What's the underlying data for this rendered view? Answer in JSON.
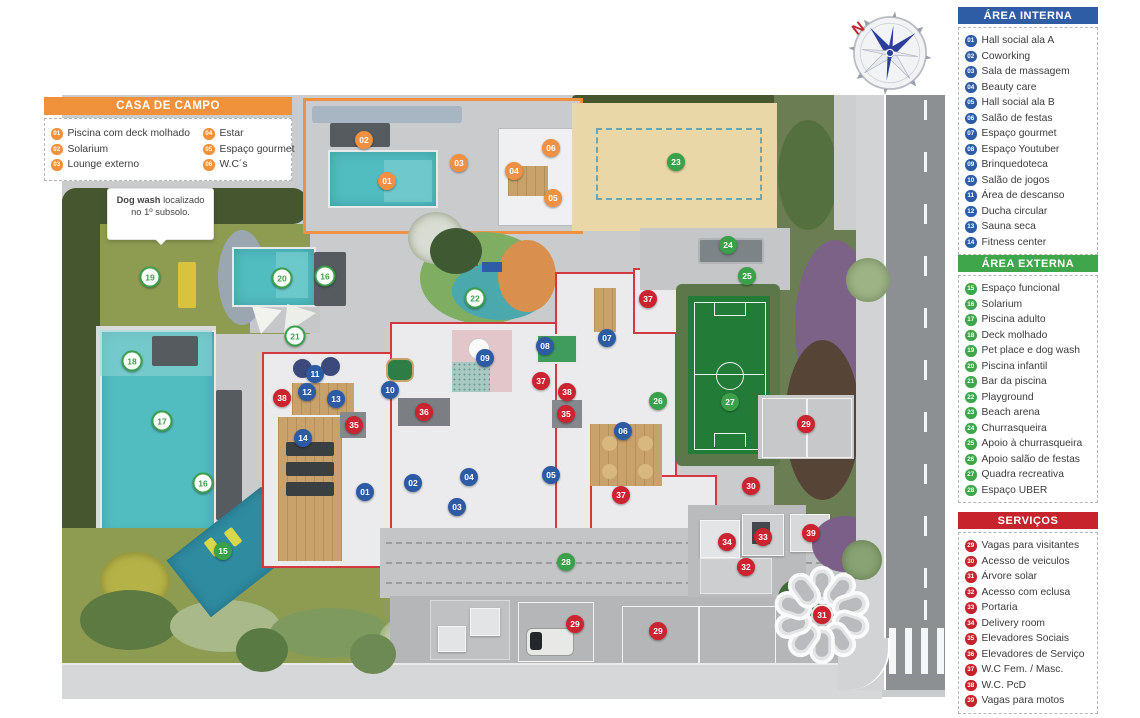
{
  "colors": {
    "area_interna": "#2e5da6",
    "area_externa": "#3fa64c",
    "servicos": "#c7232c",
    "casa_de_campo": "#f0913c",
    "pool_water": "#52bdc1",
    "court_green": "#237b38",
    "sand": "#e9d7a7",
    "building_outline_red": "#d23a40"
  },
  "compass": {
    "label": "N"
  },
  "note": {
    "bold": "Dog wash",
    "rest": " localizado no 1º subsolo."
  },
  "legends": {
    "casa_de_campo": {
      "title": "CASA DE CAMPO",
      "col1": [
        {
          "n": "01",
          "label": "Piscina com deck molhado"
        },
        {
          "n": "02",
          "label": "Solarium"
        },
        {
          "n": "03",
          "label": "Lounge externo"
        }
      ],
      "col2": [
        {
          "n": "04",
          "label": "Estar"
        },
        {
          "n": "05",
          "label": "Espaço gourmet"
        },
        {
          "n": "06",
          "label": "W.C´s"
        }
      ]
    },
    "area_interna": {
      "title": "ÁREA  INTERNA",
      "items": [
        {
          "n": "01",
          "label": "Hall social ala A"
        },
        {
          "n": "02",
          "label": "Coworking"
        },
        {
          "n": "03",
          "label": "Sala de massagem"
        },
        {
          "n": "04",
          "label": "Beauty care"
        },
        {
          "n": "05",
          "label": "Hall social ala B"
        },
        {
          "n": "06",
          "label": "Salão de festas"
        },
        {
          "n": "07",
          "label": "Espaço gourmet"
        },
        {
          "n": "08",
          "label": "Espaço Youtuber"
        },
        {
          "n": "09",
          "label": "Brinquedoteca"
        },
        {
          "n": "10",
          "label": "Salão de jogos"
        },
        {
          "n": "11",
          "label": "Área de descanso"
        },
        {
          "n": "12",
          "label": "Ducha circular"
        },
        {
          "n": "13",
          "label": "Sauna seca"
        },
        {
          "n": "14",
          "label": "Fitness center"
        }
      ]
    },
    "area_externa": {
      "title": "ÁREA EXTERNA",
      "items": [
        {
          "n": "15",
          "label": "Espaço funcional"
        },
        {
          "n": "16",
          "label": "Solarium"
        },
        {
          "n": "17",
          "label": "Piscina adulto"
        },
        {
          "n": "18",
          "label": "Deck molhado"
        },
        {
          "n": "19",
          "label": "Pet place e dog wash"
        },
        {
          "n": "20",
          "label": "Piscina infantil"
        },
        {
          "n": "21",
          "label": "Bar da piscina"
        },
        {
          "n": "22",
          "label": "Playground"
        },
        {
          "n": "23",
          "label": "Beach arena"
        },
        {
          "n": "24",
          "label": "Churrasqueira"
        },
        {
          "n": "25",
          "label": "Apoio à churrasqueira"
        },
        {
          "n": "26",
          "label": "Apoio salão de festas"
        },
        {
          "n": "27",
          "label": "Quadra recreativa"
        },
        {
          "n": "28",
          "label": "Espaço UBER"
        }
      ]
    },
    "servicos": {
      "title": "SERVIÇOS",
      "items": [
        {
          "n": "29",
          "label": "Vagas para visitantes"
        },
        {
          "n": "30",
          "label": "Acesso de veiculos"
        },
        {
          "n": "31",
          "label": "Árvore solar"
        },
        {
          "n": "32",
          "label": "Acesso com eclusa"
        },
        {
          "n": "33",
          "label": "Portaria"
        },
        {
          "n": "34",
          "label": "Delivery room"
        },
        {
          "n": "35",
          "label": "Elevadores Sociais"
        },
        {
          "n": "36",
          "label": "Elevadores de Serviço"
        },
        {
          "n": "37",
          "label": "W.C Fem. / Masc."
        },
        {
          "n": "38",
          "label": "W.C. PcD"
        },
        {
          "n": "39",
          "label": "Vagas para motos"
        }
      ]
    }
  },
  "plan": {
    "markers": [
      {
        "n": "01",
        "type": "orange",
        "x": 387,
        "y": 181
      },
      {
        "n": "02",
        "type": "orange",
        "x": 364,
        "y": 140
      },
      {
        "n": "03",
        "type": "orange",
        "x": 459,
        "y": 163
      },
      {
        "n": "04",
        "type": "orange",
        "x": 514,
        "y": 171
      },
      {
        "n": "05",
        "type": "orange",
        "x": 553,
        "y": 198
      },
      {
        "n": "06",
        "type": "orange",
        "x": 551,
        "y": 148
      },
      {
        "n": "01",
        "type": "blue",
        "x": 365,
        "y": 492
      },
      {
        "n": "02",
        "type": "blue",
        "x": 413,
        "y": 483
      },
      {
        "n": "03",
        "type": "blue",
        "x": 457,
        "y": 507
      },
      {
        "n": "04",
        "type": "blue",
        "x": 469,
        "y": 477
      },
      {
        "n": "05",
        "type": "blue",
        "x": 551,
        "y": 475
      },
      {
        "n": "06",
        "type": "blue",
        "x": 623,
        "y": 431
      },
      {
        "n": "07",
        "type": "blue",
        "x": 607,
        "y": 338
      },
      {
        "n": "08",
        "type": "blue",
        "x": 545,
        "y": 346
      },
      {
        "n": "09",
        "type": "blue",
        "x": 485,
        "y": 358
      },
      {
        "n": "10",
        "type": "blue",
        "x": 390,
        "y": 390
      },
      {
        "n": "11",
        "type": "blue",
        "x": 315,
        "y": 374
      },
      {
        "n": "12",
        "type": "blue",
        "x": 307,
        "y": 392
      },
      {
        "n": "13",
        "type": "blue",
        "x": 336,
        "y": 399
      },
      {
        "n": "14",
        "type": "blue",
        "x": 303,
        "y": 438
      },
      {
        "n": "15",
        "type": "green",
        "x": 223,
        "y": 551
      },
      {
        "n": "16",
        "type": "greeno",
        "x": 325,
        "y": 276
      },
      {
        "n": "16",
        "type": "greeno",
        "x": 203,
        "y": 483
      },
      {
        "n": "17",
        "type": "greeno",
        "x": 162,
        "y": 421
      },
      {
        "n": "18",
        "type": "greeno",
        "x": 132,
        "y": 361
      },
      {
        "n": "19",
        "type": "greeno",
        "x": 150,
        "y": 277
      },
      {
        "n": "20",
        "type": "greeno",
        "x": 282,
        "y": 278
      },
      {
        "n": "21",
        "type": "greeno",
        "x": 295,
        "y": 336
      },
      {
        "n": "22",
        "type": "greeno",
        "x": 475,
        "y": 298
      },
      {
        "n": "23",
        "type": "green",
        "x": 676,
        "y": 162
      },
      {
        "n": "24",
        "type": "green",
        "x": 728,
        "y": 245
      },
      {
        "n": "25",
        "type": "green",
        "x": 747,
        "y": 276
      },
      {
        "n": "26",
        "type": "green",
        "x": 658,
        "y": 401
      },
      {
        "n": "27",
        "type": "green",
        "x": 730,
        "y": 402
      },
      {
        "n": "28",
        "type": "green",
        "x": 566,
        "y": 562
      },
      {
        "n": "29",
        "type": "red",
        "x": 806,
        "y": 424
      },
      {
        "n": "29",
        "type": "red",
        "x": 575,
        "y": 624
      },
      {
        "n": "29",
        "type": "red",
        "x": 658,
        "y": 631
      },
      {
        "n": "30",
        "type": "red",
        "x": 751,
        "y": 486
      },
      {
        "n": "31",
        "type": "red",
        "x": 822,
        "y": 615
      },
      {
        "n": "32",
        "type": "red",
        "x": 746,
        "y": 567
      },
      {
        "n": "33",
        "type": "red",
        "x": 763,
        "y": 537
      },
      {
        "n": "34",
        "type": "red",
        "x": 727,
        "y": 542
      },
      {
        "n": "35",
        "type": "red",
        "x": 354,
        "y": 425
      },
      {
        "n": "35",
        "type": "red",
        "x": 566,
        "y": 414
      },
      {
        "n": "36",
        "type": "red",
        "x": 424,
        "y": 412
      },
      {
        "n": "37",
        "type": "red",
        "x": 648,
        "y": 299
      },
      {
        "n": "37",
        "type": "red",
        "x": 541,
        "y": 381
      },
      {
        "n": "37",
        "type": "red",
        "x": 621,
        "y": 495
      },
      {
        "n": "38",
        "type": "red",
        "x": 282,
        "y": 398
      },
      {
        "n": "38",
        "type": "red",
        "x": 567,
        "y": 392
      },
      {
        "n": "39",
        "type": "red",
        "x": 811,
        "y": 533
      }
    ]
  }
}
